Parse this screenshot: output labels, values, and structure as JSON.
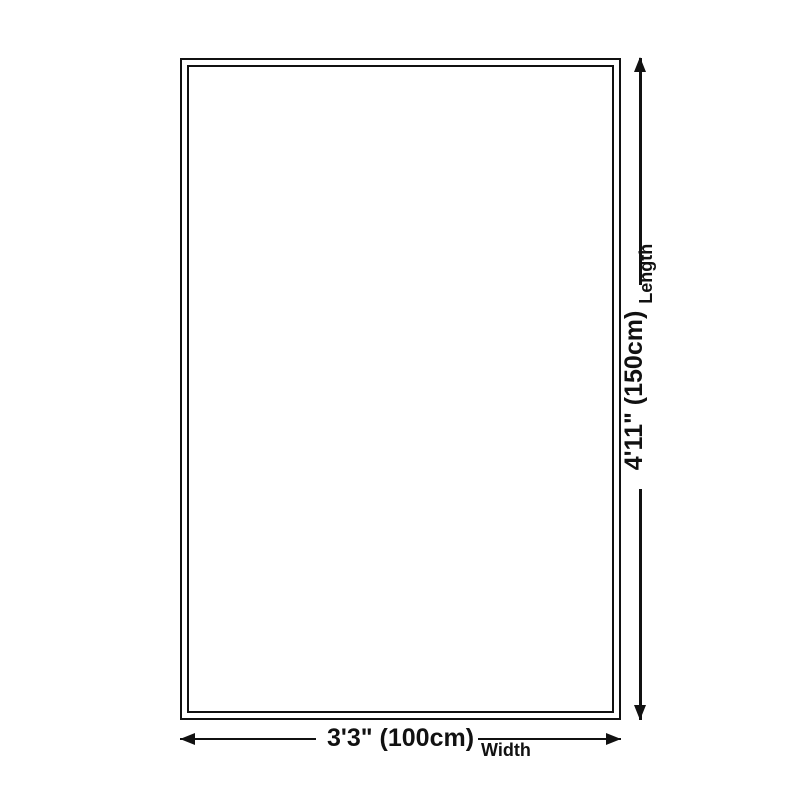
{
  "diagram": {
    "background_color": "#ffffff",
    "line_color": "#111111",
    "length": {
      "value": "4'11\" (150cm)",
      "label": "Length"
    },
    "width": {
      "value": "3'3\" (100cm)",
      "label": "Width"
    }
  }
}
